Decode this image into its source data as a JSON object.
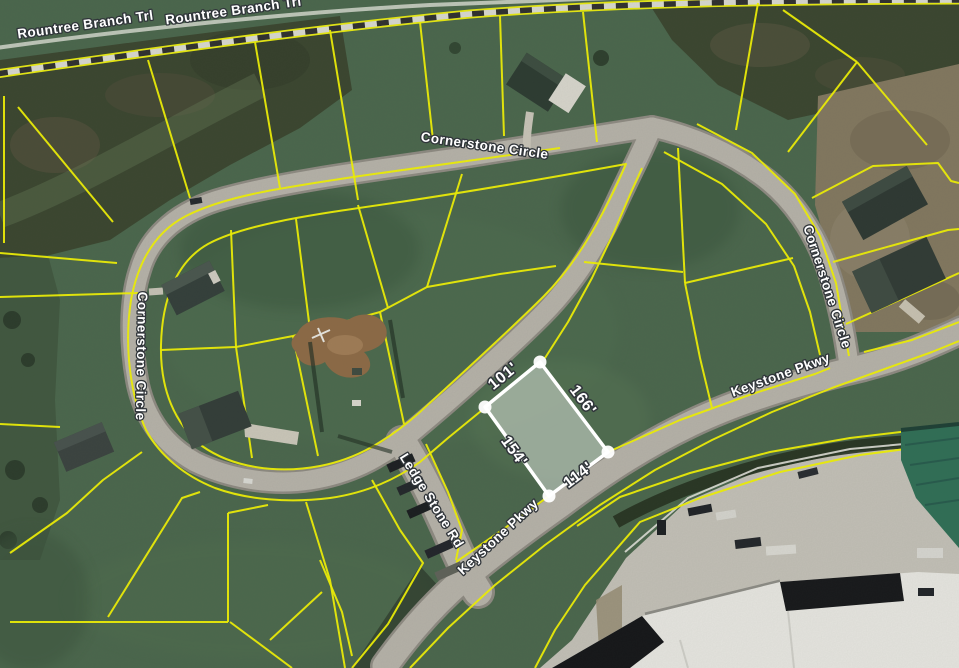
{
  "map": {
    "description": "Aerial GIS parcel map with lot lines and a selected lot showing edge dimensions",
    "road_labels": {
      "rountree_1": "Rountree Branch Trl",
      "rountree_2": "Rountree Branch Trl",
      "cornerstone_top": "Cornerstone Circle",
      "cornerstone_left": "Cornerstone Circle",
      "cornerstone_right": "Cornerstone Circle",
      "keystone_upper": "Keystone Pkwy",
      "keystone_lower": "Keystone Pkwy",
      "ledge_stone": "Ledge Stone Rd"
    },
    "selected_parcel": {
      "dim_nw": "101'",
      "dim_ne": "166'",
      "dim_sw": "154'",
      "dim_se": "114'"
    },
    "colors": {
      "grass": "#4a664c",
      "woods": "#3a452f",
      "dirt_tan": "#82775f",
      "construction_dirt": "#8d6a46",
      "road_fill": "#b6b2a9",
      "road_casing": "#8e8a82",
      "parcel_line": "#f0f104",
      "selection": "#ffffff",
      "label_fill": "#ffffff",
      "label_halo": "#30353a",
      "railroad_dark": "#2f2f2f",
      "railroad_light": "#d9d9d1",
      "industrial_white_roof": "#e7e6e1",
      "industrial_green_roof": "#2f6e56",
      "concrete": "#c3c0b7"
    }
  }
}
